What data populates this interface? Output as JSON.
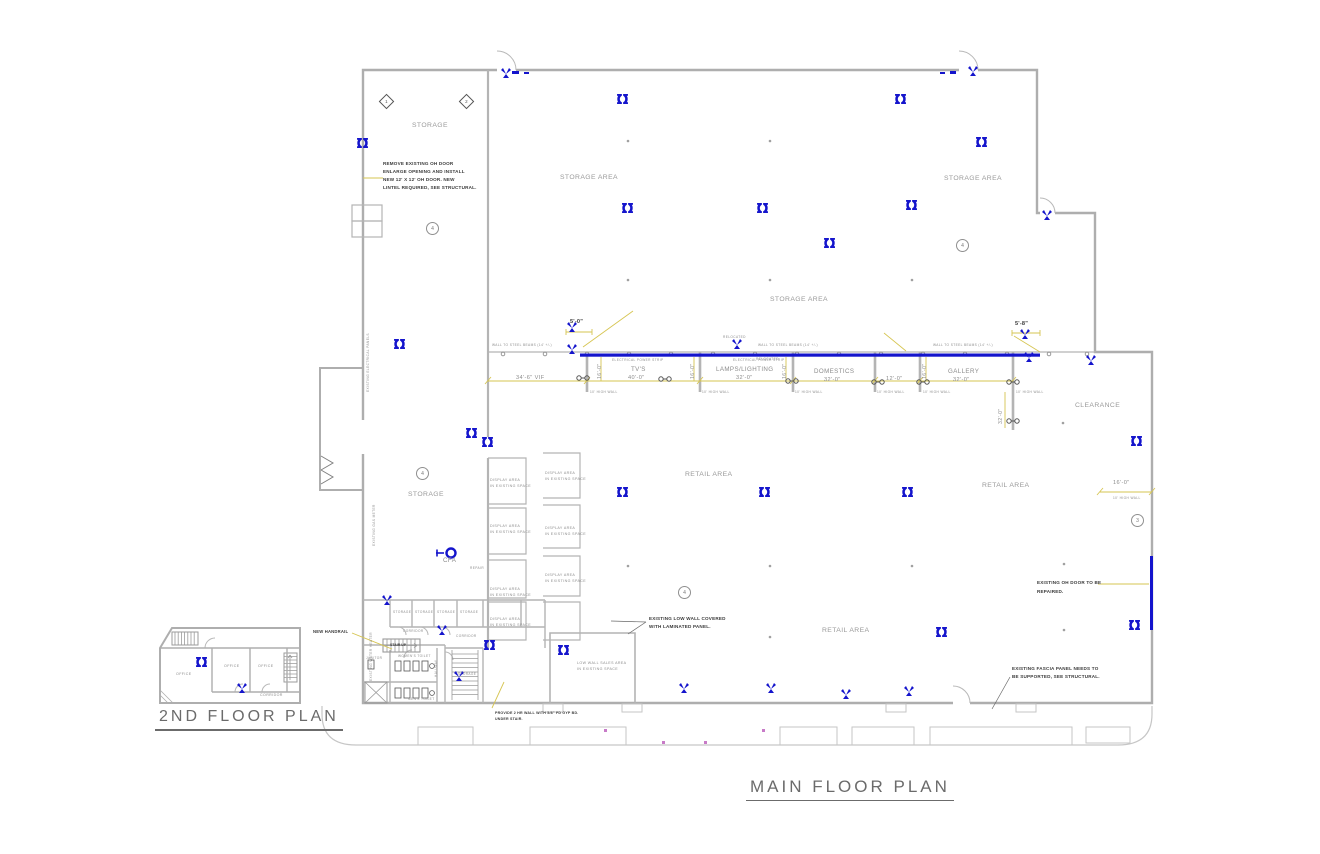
{
  "sheet": {
    "main_title": "MAIN FLOOR PLAN",
    "second_title": "2ND FLOOR PLAN"
  },
  "areas": {
    "storage": "STORAGE",
    "storage_area": "STORAGE AREA",
    "retail_area": "RETAIL AREA",
    "clearance": "CLEARANCE"
  },
  "departments": [
    {
      "name": "TV'S",
      "dim": "40'-0\""
    },
    {
      "name": "LAMPS/LIGHTING",
      "dim": "32'-0\""
    },
    {
      "name": "DOMESTICS",
      "dim": "32'-0\""
    },
    {
      "name": "GALLERY",
      "dim": "32'-0\""
    }
  ],
  "dims": {
    "d34_6": "34'-6\" VIF",
    "d5_0": "5'-0\"",
    "d5_8": "5'-8\"",
    "d12_0": "12'-0\"",
    "d16_0": "16'-0\"",
    "d32_0": "32'-0\"",
    "wall10": "10' HIGH WALL",
    "beams": "WALL TO STEEL BEAMS (14' +/-)",
    "power_strip": "ELECTRICAL POWER STRIP",
    "relocated": "RELOCATED"
  },
  "notes": {
    "oh_door": [
      "REMOVE  EXISTING OH DOOR",
      "ENLARGE OPENING AND INSTALL",
      "NEW 12' X 12' OH DOOR. NEW",
      "LINTEL REQUIRED, SEE STRUCTURAL."
    ],
    "low_wall": [
      "EXISTING LOW WALL COVERED",
      "WITH LAMINATED PANEL."
    ],
    "oh_repair": [
      "EXISTING OH DOOR TO BE",
      "REPAIRED."
    ],
    "fascia": [
      "EXISTING FASCIA PANEL NEEDS TO",
      "BE SUPPORTED, SEE STRUCTURAL."
    ],
    "two_hr": [
      "PROVIDE 2 HR WALL WITH 5/8\" FD GYP BD.",
      "UNDER STAIR."
    ],
    "handrail": "NEW HANDRAIL"
  },
  "equipment": {
    "elec_panels": "EXISTING ELECTRICAL PANELS",
    "gas_meter": "EXISTING GAS METER",
    "water_heater": "EXISTING WATER HEATER",
    "cfa": "CFA",
    "repair": "REPAIR"
  },
  "display": {
    "line1": "DISPLAY AREA",
    "line2": "IN EXISTING SPACE"
  },
  "low_sales": {
    "line1": "LOW WALL SALES AREA",
    "line2": "IN EXISTING SPACE"
  },
  "rooms": {
    "corridor": "CORRIDOR",
    "stair_up": "STAIR UP",
    "janitor": "JANITOR",
    "womens_toilet": "WOMEN'S TOILET",
    "mens_toilet": "MEN'S TOILET",
    "hallway": "HALLWAY",
    "office": "OFFICE"
  },
  "keynotes": {
    "k1": "1",
    "k2": "2",
    "k3": "3",
    "k4": "4"
  }
}
